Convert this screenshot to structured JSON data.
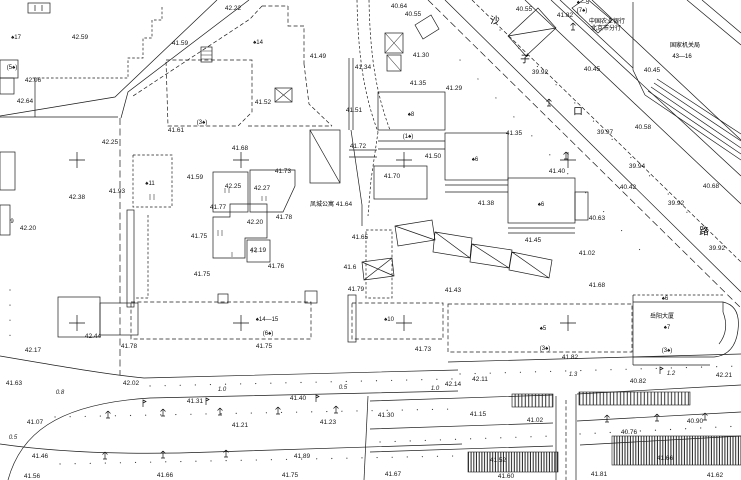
{
  "drawing": {
    "type": "cadastral-topographic-survey-map",
    "background_color": "#ffffff",
    "ink_color": "#1c1c1c",
    "road_name_chars": [
      {
        "t": "沙",
        "x": 495,
        "y": 21
      },
      {
        "t": "子",
        "x": 525,
        "y": 60
      },
      {
        "t": "口",
        "x": 578,
        "y": 112
      },
      {
        "t": "路",
        "x": 704,
        "y": 232
      }
    ],
    "place_names": [
      {
        "t": "中国农业银行",
        "x": 607,
        "y": 22
      },
      {
        "t": "北京市分行",
        "x": 606,
        "y": 29
      },
      {
        "t": "国家机关局",
        "x": 685,
        "y": 46
      },
      {
        "t": "43—16",
        "x": 682,
        "y": 57
      },
      {
        "t": "凤城公寓",
        "x": 322,
        "y": 205
      },
      {
        "t": "岳阳大厦",
        "x": 662,
        "y": 317
      }
    ],
    "building_codes": [
      {
        "t": "♠17",
        "x": 16,
        "y": 38
      },
      {
        "t": "(5♠)",
        "x": 12,
        "y": 68
      },
      {
        "t": "(3♠)",
        "x": 202,
        "y": 123
      },
      {
        "t": "♠14",
        "x": 258,
        "y": 43
      },
      {
        "t": "♠—5",
        "x": 583,
        "y": 3
      },
      {
        "t": "(7♠)",
        "x": 582,
        "y": 11
      },
      {
        "t": "♠11",
        "x": 150,
        "y": 184
      },
      {
        "t": "♠8",
        "x": 411,
        "y": 115
      },
      {
        "t": "(1♠)",
        "x": 408,
        "y": 137
      },
      {
        "t": "♠6",
        "x": 475,
        "y": 160
      },
      {
        "t": "♠6",
        "x": 541,
        "y": 205
      },
      {
        "t": "♠14—15",
        "x": 267,
        "y": 320
      },
      {
        "t": "(6♠)",
        "x": 268,
        "y": 334
      },
      {
        "t": "♠10",
        "x": 389,
        "y": 320
      },
      {
        "t": "♠5",
        "x": 543,
        "y": 329
      },
      {
        "t": "(3♠)",
        "x": 545,
        "y": 349
      },
      {
        "t": "♠6",
        "x": 665,
        "y": 299
      },
      {
        "t": "♠7",
        "x": 667,
        "y": 328
      },
      {
        "t": "(3♠)",
        "x": 667,
        "y": 351
      },
      {
        "t": "9",
        "x": 12,
        "y": 222
      }
    ],
    "spot_elevations": [
      {
        "t": "42.22",
        "x": 233,
        "y": 9
      },
      {
        "t": "42.59",
        "x": 80,
        "y": 38
      },
      {
        "t": "42.06",
        "x": 33,
        "y": 81
      },
      {
        "t": "42.64",
        "x": 25,
        "y": 102
      },
      {
        "t": "41.59",
        "x": 180,
        "y": 44
      },
      {
        "t": "41.61",
        "x": 176,
        "y": 131
      },
      {
        "t": "41.49",
        "x": 318,
        "y": 57
      },
      {
        "t": "41.52",
        "x": 263,
        "y": 103
      },
      {
        "t": "41.51",
        "x": 354,
        "y": 111
      },
      {
        "t": "41.72",
        "x": 358,
        "y": 147
      },
      {
        "t": "40.64",
        "x": 399,
        "y": 7
      },
      {
        "t": "40.55",
        "x": 413,
        "y": 15
      },
      {
        "t": "41.34",
        "x": 363,
        "y": 68
      },
      {
        "t": "41.30",
        "x": 421,
        "y": 56
      },
      {
        "t": "41.35",
        "x": 418,
        "y": 84
      },
      {
        "t": "41.29",
        "x": 454,
        "y": 89
      },
      {
        "t": "41.50",
        "x": 433,
        "y": 157
      },
      {
        "t": "41.70",
        "x": 392,
        "y": 177
      },
      {
        "t": "41.35",
        "x": 514,
        "y": 134
      },
      {
        "t": "41.40",
        "x": 557,
        "y": 172
      },
      {
        "t": "41.38",
        "x": 486,
        "y": 204
      },
      {
        "t": "41.45",
        "x": 533,
        "y": 241
      },
      {
        "t": "40.55",
        "x": 524,
        "y": 10
      },
      {
        "t": "41.82",
        "x": 565,
        "y": 16
      },
      {
        "t": "39.92",
        "x": 540,
        "y": 73
      },
      {
        "t": "40.45",
        "x": 592,
        "y": 70
      },
      {
        "t": "40.45",
        "x": 652,
        "y": 71
      },
      {
        "t": "39.97",
        "x": 605,
        "y": 133
      },
      {
        "t": "40.58",
        "x": 643,
        "y": 128
      },
      {
        "t": "39.94",
        "x": 637,
        "y": 167
      },
      {
        "t": "40.42",
        "x": 628,
        "y": 188
      },
      {
        "t": "40.68",
        "x": 711,
        "y": 187
      },
      {
        "t": "39.92",
        "x": 676,
        "y": 204
      },
      {
        "t": "40.63",
        "x": 597,
        "y": 219
      },
      {
        "t": "39.92",
        "x": 717,
        "y": 249
      },
      {
        "t": "41.02",
        "x": 587,
        "y": 254
      },
      {
        "t": "41.68",
        "x": 597,
        "y": 286
      },
      {
        "t": "42.25",
        "x": 110,
        "y": 143
      },
      {
        "t": "42.38",
        "x": 77,
        "y": 198
      },
      {
        "t": "41.93",
        "x": 117,
        "y": 192
      },
      {
        "t": "41.59",
        "x": 195,
        "y": 178
      },
      {
        "t": "42.20",
        "x": 28,
        "y": 229
      },
      {
        "t": "41.68",
        "x": 240,
        "y": 149
      },
      {
        "t": "41.73",
        "x": 283,
        "y": 172
      },
      {
        "t": "42.25",
        "x": 233,
        "y": 187
      },
      {
        "t": "42.27",
        "x": 262,
        "y": 189
      },
      {
        "t": "41.77",
        "x": 218,
        "y": 208
      },
      {
        "t": "42.20",
        "x": 255,
        "y": 223
      },
      {
        "t": "41.78",
        "x": 284,
        "y": 218
      },
      {
        "t": "41.75",
        "x": 199,
        "y": 237
      },
      {
        "t": "42.19",
        "x": 258,
        "y": 251
      },
      {
        "t": "41.76",
        "x": 276,
        "y": 267
      },
      {
        "t": "41.75",
        "x": 202,
        "y": 275
      },
      {
        "t": "41.64",
        "x": 344,
        "y": 205
      },
      {
        "t": "41.65",
        "x": 360,
        "y": 238
      },
      {
        "t": "41.6",
        "x": 350,
        "y": 268
      },
      {
        "t": "41.43",
        "x": 453,
        "y": 291
      },
      {
        "t": "41.79",
        "x": 356,
        "y": 290
      },
      {
        "t": "41.75",
        "x": 264,
        "y": 347
      },
      {
        "t": "41.73",
        "x": 423,
        "y": 350
      },
      {
        "t": "41.82",
        "x": 570,
        "y": 358
      },
      {
        "t": "41.63",
        "x": 14,
        "y": 384
      },
      {
        "t": "42.17",
        "x": 33,
        "y": 351
      },
      {
        "t": "42.44",
        "x": 93,
        "y": 337
      },
      {
        "t": "41.78",
        "x": 129,
        "y": 347
      },
      {
        "t": "42.02",
        "x": 131,
        "y": 384
      },
      {
        "t": "41.31",
        "x": 195,
        "y": 402
      },
      {
        "t": "41.40",
        "x": 298,
        "y": 399
      },
      {
        "t": "41.21",
        "x": 240,
        "y": 426
      },
      {
        "t": "41.23",
        "x": 328,
        "y": 423
      },
      {
        "t": "41.07",
        "x": 35,
        "y": 423
      },
      {
        "t": "41.46",
        "x": 40,
        "y": 457
      },
      {
        "t": "41.89",
        "x": 302,
        "y": 457
      },
      {
        "t": "41.56",
        "x": 32,
        "y": 477
      },
      {
        "t": "41.66",
        "x": 165,
        "y": 476
      },
      {
        "t": "41.75",
        "x": 290,
        "y": 476
      },
      {
        "t": "42.14",
        "x": 453,
        "y": 385
      },
      {
        "t": "42.11",
        "x": 480,
        "y": 380
      },
      {
        "t": "40.82",
        "x": 638,
        "y": 382
      },
      {
        "t": "42.21",
        "x": 724,
        "y": 376
      },
      {
        "t": "41.30",
        "x": 386,
        "y": 416
      },
      {
        "t": "41.15",
        "x": 478,
        "y": 415
      },
      {
        "t": "41.02",
        "x": 535,
        "y": 421
      },
      {
        "t": "40.76",
        "x": 629,
        "y": 433
      },
      {
        "t": "40.90",
        "x": 695,
        "y": 422
      },
      {
        "t": "41.52",
        "x": 498,
        "y": 461
      },
      {
        "t": "41.66",
        "x": 665,
        "y": 459
      },
      {
        "t": "41.67",
        "x": 393,
        "y": 475
      },
      {
        "t": "41.60",
        "x": 506,
        "y": 477
      },
      {
        "t": "41.81",
        "x": 599,
        "y": 475
      },
      {
        "t": "41.62",
        "x": 715,
        "y": 476
      }
    ],
    "curb_widths": [
      {
        "t": "0.8",
        "x": 60,
        "y": 393
      },
      {
        "t": "1.0",
        "x": 222,
        "y": 390
      },
      {
        "t": "0.5",
        "x": 343,
        "y": 388
      },
      {
        "t": "1.0",
        "x": 435,
        "y": 389
      },
      {
        "t": "1.3",
        "x": 573,
        "y": 375
      },
      {
        "t": "1.2",
        "x": 671,
        "y": 374
      },
      {
        "t": "0.5",
        "x": 13,
        "y": 438
      }
    ],
    "grid_crosses": [
      [
        77,
        160
      ],
      [
        241,
        160
      ],
      [
        404,
        160
      ],
      [
        568,
        160
      ],
      [
        77,
        323
      ],
      [
        241,
        323
      ],
      [
        404,
        323
      ],
      [
        568,
        323
      ]
    ],
    "tree_symbols": [
      [
        108,
        415
      ],
      [
        163,
        413
      ],
      [
        220,
        412
      ],
      [
        278,
        411
      ],
      [
        336,
        410
      ],
      [
        607,
        419
      ],
      [
        657,
        418
      ],
      [
        705,
        417
      ],
      [
        105,
        456
      ],
      [
        163,
        455
      ],
      [
        226,
        454
      ],
      [
        573,
        27
      ],
      [
        549,
        103
      ],
      [
        566,
        156
      ]
    ],
    "lamp_symbols": [
      [
        143,
        404
      ],
      [
        206,
        402
      ],
      [
        316,
        399
      ],
      [
        660,
        371
      ]
    ]
  }
}
